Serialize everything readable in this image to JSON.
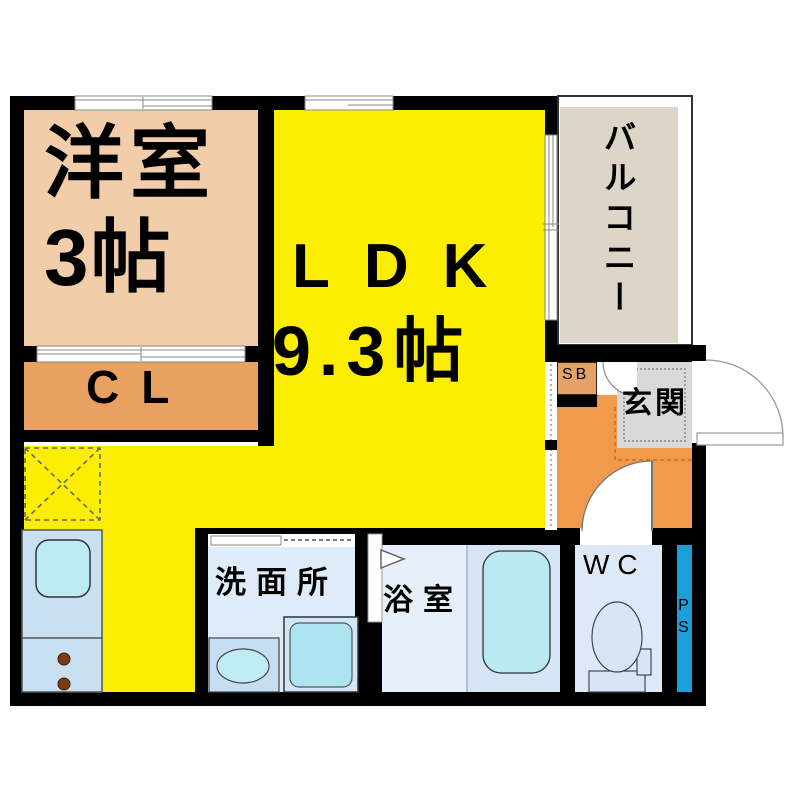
{
  "plan": {
    "wall_color": "#000000",
    "rooms": {
      "western_room": {
        "name": "洋室",
        "size": "3帖",
        "color": "#F2CDA9"
      },
      "ldk": {
        "name": "LDK",
        "size": "9.3帖",
        "color": "#FBEE00"
      },
      "closet": {
        "label": "CL",
        "color": "#E8A160"
      },
      "balcony": {
        "label": "バルコニー",
        "color": "#DDD5C8"
      },
      "entrance_hall": {
        "label": "玄関",
        "floor_color": "#D9D9D9",
        "hall_color": "#EF9A4D"
      },
      "shoe_box": {
        "label": "SB",
        "color": "#E5A268"
      },
      "washroom": {
        "label": "洗面所",
        "color": "#DEEBF8"
      },
      "bathroom": {
        "label": "浴室",
        "color": "#E7F0FA"
      },
      "toilet": {
        "label": "WC",
        "color": "#DDE9F7"
      },
      "pipe_space": {
        "label": "PS",
        "color": "#1C9ED9"
      }
    }
  }
}
